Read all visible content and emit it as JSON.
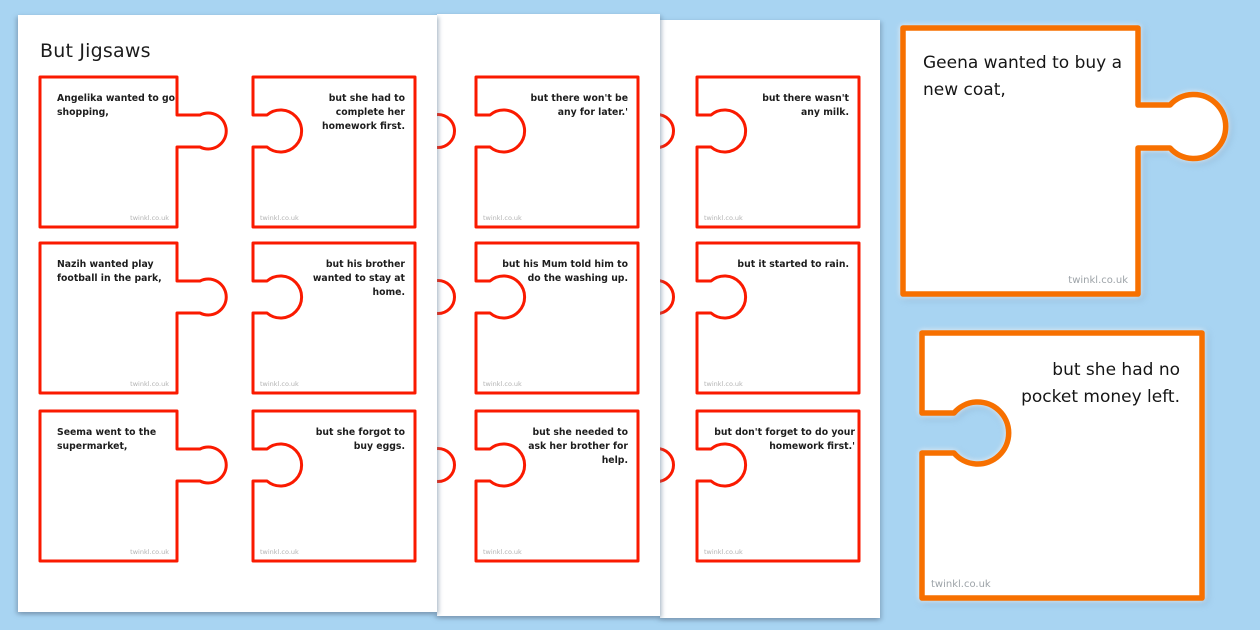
{
  "title": "But Jigsaws",
  "watermark": "twinkl.co.uk",
  "colors": {
    "background": "#a8d4f2",
    "page": "#ffffff",
    "small_piece_border": "#fa1a00",
    "large_piece_border": "#f77000",
    "text": "#1d1d1d",
    "watermark_gray": "#b3b3b3"
  },
  "pages": [
    {
      "name": "page-1",
      "rows": [
        {
          "left": "Angelika wanted to go shopping,",
          "right": "but she had to complete her homework first."
        },
        {
          "left": "Nazih wanted play football in the park,",
          "right": "but his brother wanted to stay at home."
        },
        {
          "left": "Seema went to the supermarket,",
          "right": "but she forgot to buy eggs."
        }
      ]
    },
    {
      "name": "page-2",
      "rows": [
        {
          "right": "but there won't be any for later.'"
        },
        {
          "right": "but his Mum told him to do the washing up."
        },
        {
          "right": "but she needed to ask her brother for help."
        }
      ]
    },
    {
      "name": "page-3",
      "rows": [
        {
          "right": "but there wasn't any milk."
        },
        {
          "right": "but it started to rain."
        },
        {
          "right": "but don't forget to do your homework first.'"
        }
      ]
    }
  ],
  "large_pair": {
    "left": "Geena wanted to buy a new coat,",
    "right": "but she had no pocket money left."
  }
}
